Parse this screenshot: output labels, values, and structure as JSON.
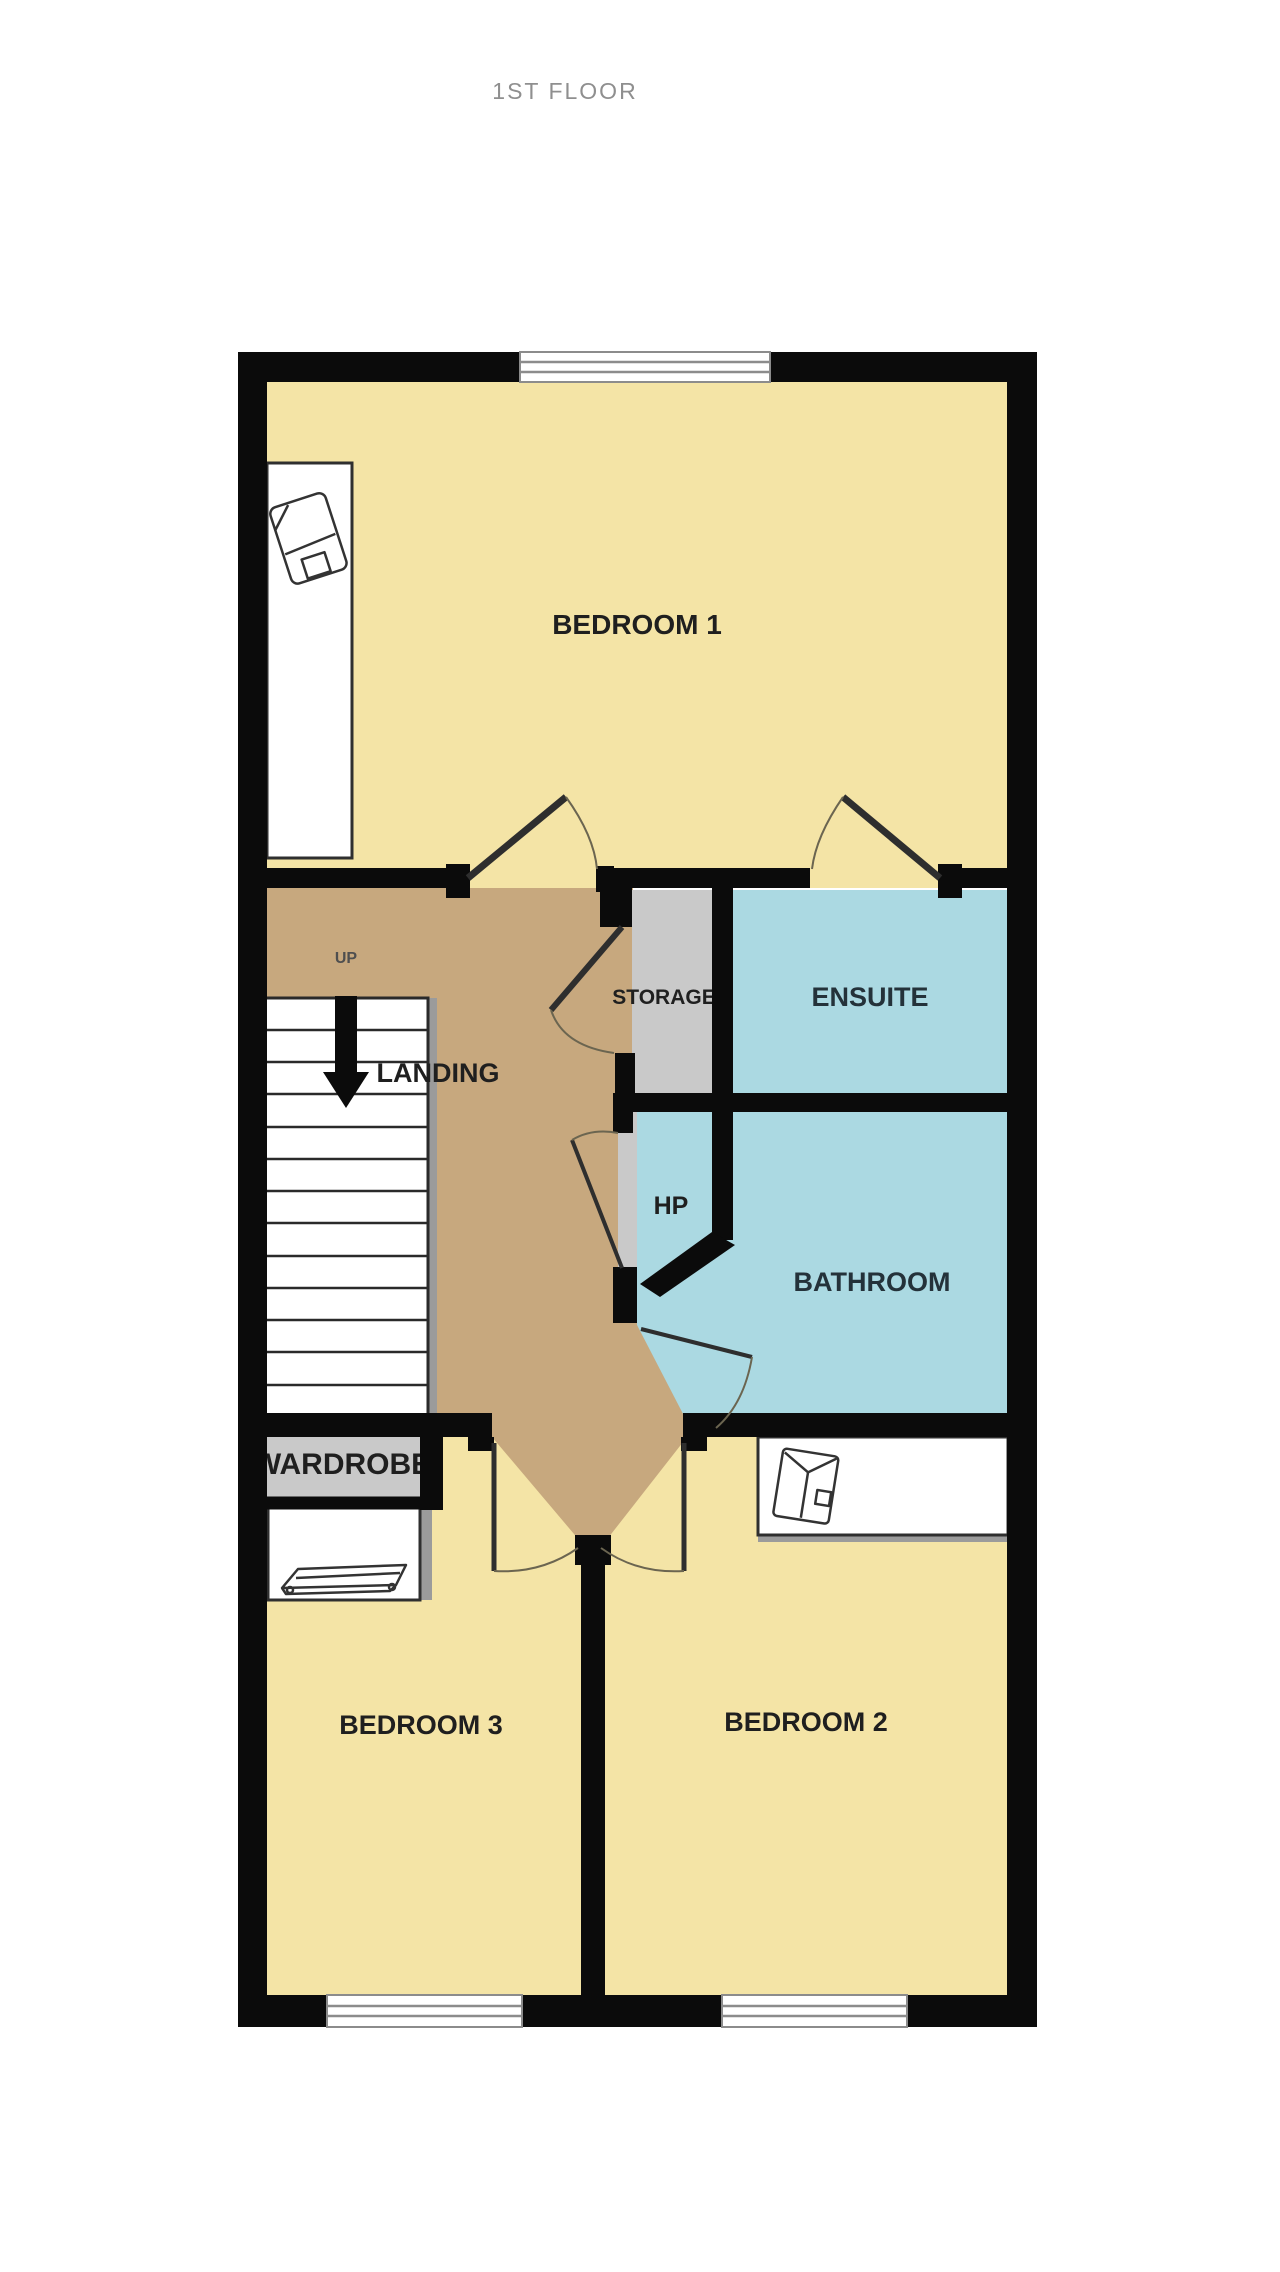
{
  "title": "1ST FLOOR",
  "colors": {
    "wall": "#0b0b0b",
    "floor_bedroom": "#f4e4a6",
    "floor_landing": "#c7a87e",
    "floor_utility": "#c9c9c9",
    "floor_wet": "#abd9e2",
    "window_frame": "#8c8c8c",
    "title_text": "#8f8f8f",
    "label_text": "#1f1f1f",
    "shadow": "#9b9b9b"
  },
  "rooms": {
    "bedroom1": {
      "label": "BEDROOM 1"
    },
    "storage": {
      "label": "STORAGE"
    },
    "ensuite": {
      "label": "ENSUITE"
    },
    "landing": {
      "label": "LANDING"
    },
    "hp": {
      "label": "HP"
    },
    "bathroom": {
      "label": "BATHROOM"
    },
    "wardrobe": {
      "label": "WARDROBE"
    },
    "bedroom3": {
      "label": "BEDROOM 3"
    },
    "bedroom2": {
      "label": "BEDROOM 2"
    }
  },
  "annotations": {
    "stairs_direction": "UP"
  },
  "icons": {
    "stairs_arrow": "down-arrow-icon",
    "bedroom1_furniture": "chair-icon",
    "bedroom2_furniture": "shirt-icon",
    "bedroom3_furniture": "chest-icon"
  }
}
